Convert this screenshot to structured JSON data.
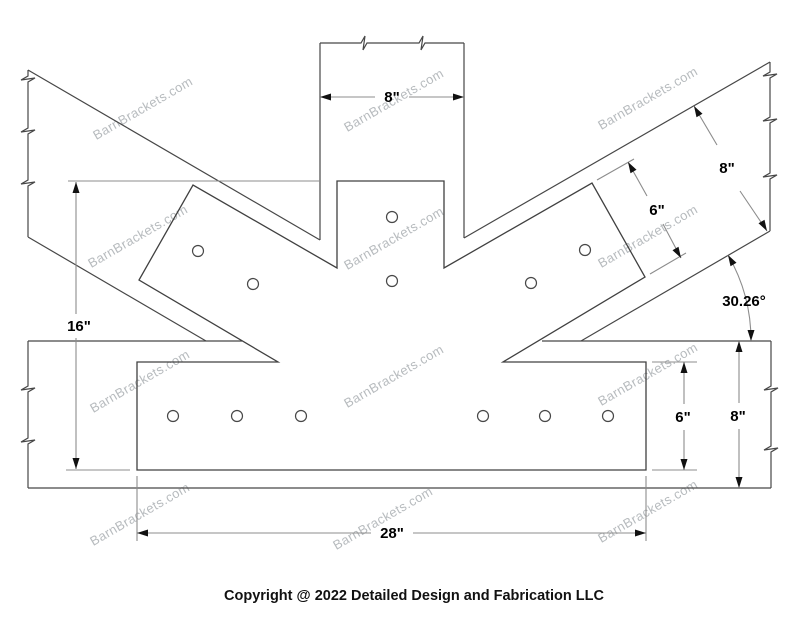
{
  "watermark": {
    "text": "BarnBrackets.com"
  },
  "footer": {
    "copyright": "Copyright @ 2022 Detailed Design and Fabrication LLC"
  },
  "dims": {
    "post_width": "8\"",
    "overall_height": "16\"",
    "plate_length": "28\"",
    "plate_height": "6\"",
    "beam_height": "8\"",
    "diag_beam_width": "8\"",
    "arm_plate_width": "6\"",
    "brace_angle": "30.26°"
  }
}
